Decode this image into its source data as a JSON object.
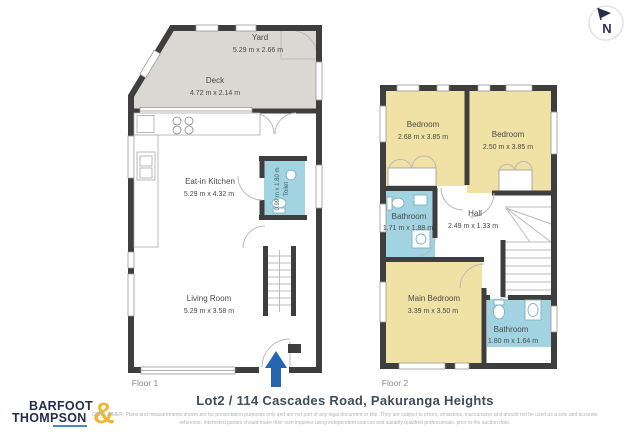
{
  "compass": {
    "label": "N"
  },
  "floors": {
    "floor1": {
      "caption": "Floor 1",
      "yard": {
        "name": "Yard",
        "dims": "5.29 m x 2.66 m"
      },
      "deck": {
        "name": "Deck",
        "dims": "4.72 m x 2.14 m"
      },
      "kitchen": {
        "name": "Eat-in Kitchen",
        "dims": "5.29 m x 4.32 m"
      },
      "toilet": {
        "name": "Toilet",
        "dims": "0.99 m x 1.80 m"
      },
      "living": {
        "name": "Living Room",
        "dims": "5.29 m x 3.58 m"
      }
    },
    "floor2": {
      "caption": "Floor 2",
      "bedroom1": {
        "name": "Bedroom",
        "dims": "2.68 m x 3.85 m"
      },
      "bedroom2": {
        "name": "Bedroom",
        "dims": "2.50 m x 3.85 m"
      },
      "bathroom1": {
        "name": "Bathroom",
        "dims": "1.71 m x 1.88 m"
      },
      "hall": {
        "name": "Hall",
        "dims": "2.49 m x 1.33 m"
      },
      "main_bedroom": {
        "name": "Main Bedroom",
        "dims": "3.39 m x 3.50 m"
      },
      "bathroom2": {
        "name": "Bathroom",
        "dims": "1.80 m x 1.64 m"
      }
    }
  },
  "footer": {
    "address": "Lot2 / 114 Cascades Road, Pakuranga Heights",
    "disclaimer": "DISCLAIMER: Plans and measurements shown are for presentation purposes only and are not part of any legal document or title. They are subject to errors, omissions, inaccuracies and should not be used as a sole and accurate reference. Interested parties should make their own inquiries using independent sources and suitably qualified professionals, prior to the auction date."
  },
  "logo": {
    "word1": "BARFOOT",
    "word2": "THOMPSON",
    "ampersand": "&"
  },
  "colors": {
    "wall": "#3e3e3e",
    "bedroom_fill": "#f0e1a4",
    "bathroom_fill": "#a2d3e0",
    "outdoor_fill": "#d9d8d3",
    "entry_arrow": "#2565af",
    "logo_navy": "#252e4e",
    "logo_gold": "#eeb735"
  }
}
